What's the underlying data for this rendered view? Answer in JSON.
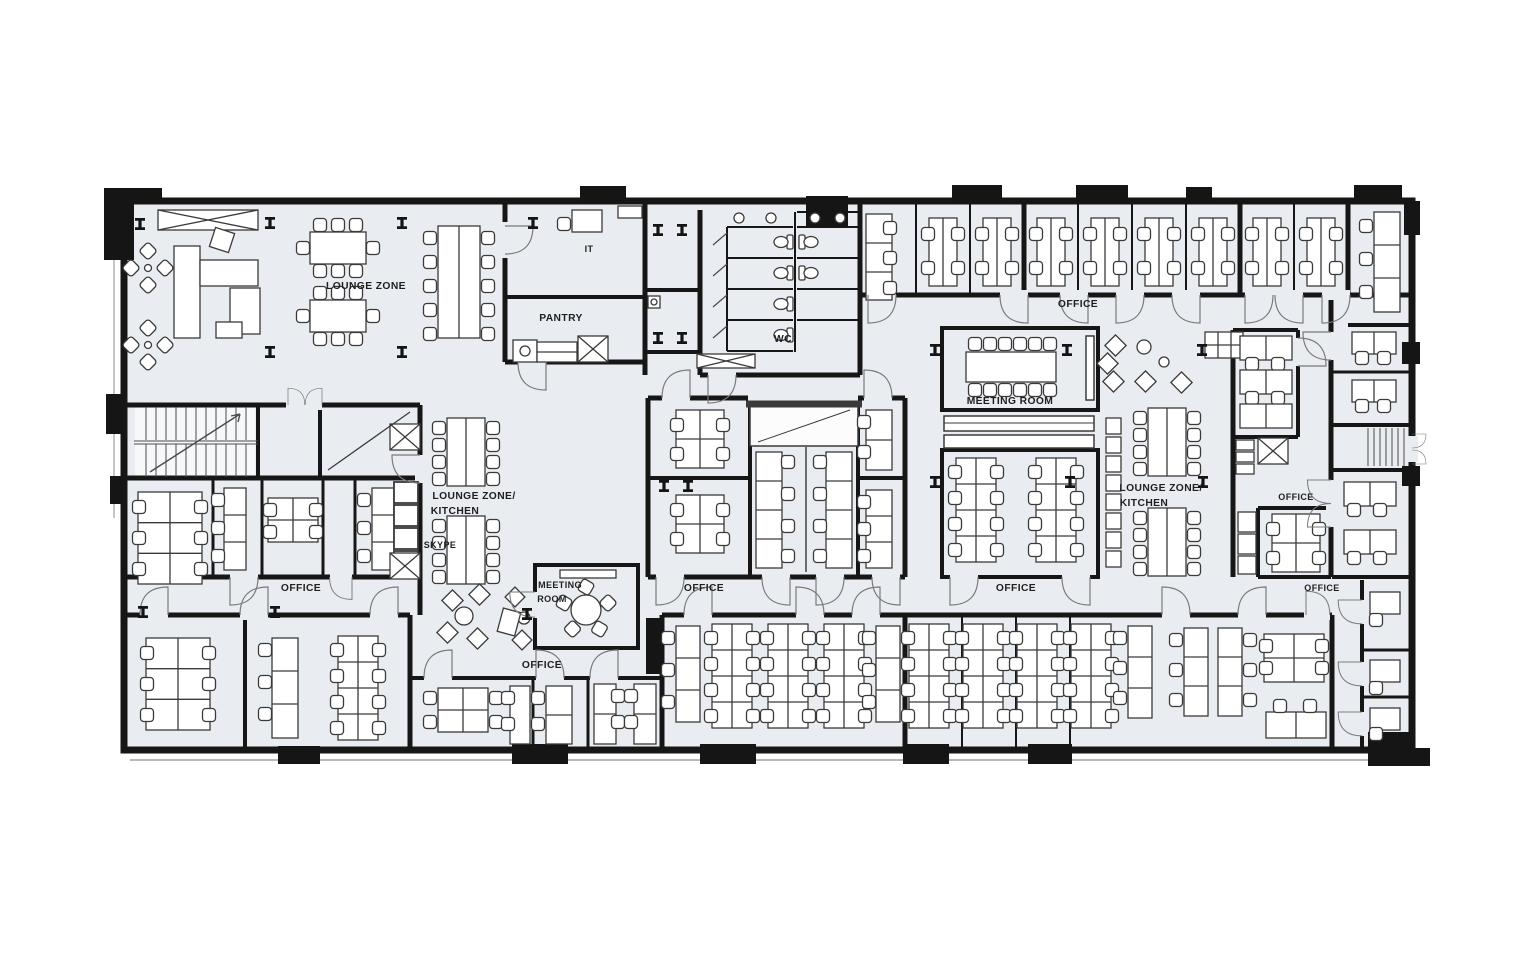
{
  "meta": {
    "title": "Office floor plan",
    "drawing_type": "architectural-floor-plan"
  },
  "colors": {
    "background": "#ffffff",
    "floor": "#e9edf2",
    "wall": "#161616",
    "furniture_stroke": "#3a3a3a",
    "door_stroke": "#7a7a7a",
    "label": "#1f1f1f"
  },
  "labels": [
    {
      "id": "lounge-zone-nw",
      "text": "LOUNGE ZONE"
    },
    {
      "id": "it-room",
      "text": "IT"
    },
    {
      "id": "pantry",
      "text": "PANTRY"
    },
    {
      "id": "wc",
      "text": "WC"
    },
    {
      "id": "office-north",
      "text": "OFFICE"
    },
    {
      "id": "meeting-room-main",
      "text": "MEETING ROOM"
    },
    {
      "id": "lounge-kitchen-west-1",
      "text": "LOUNGE ZONE/"
    },
    {
      "id": "lounge-kitchen-west-2",
      "text": "KITCHEN"
    },
    {
      "id": "skype-booth",
      "text": "SKYPE"
    },
    {
      "id": "meeting-room-small-1",
      "text": "MEETING"
    },
    {
      "id": "meeting-room-small-2",
      "text": "ROOM"
    },
    {
      "id": "office-west",
      "text": "OFFICE"
    },
    {
      "id": "office-center",
      "text": "OFFICE"
    },
    {
      "id": "office-mid-east",
      "text": "OFFICE"
    },
    {
      "id": "lounge-kitchen-east-1",
      "text": "LOUNGE ZONE/"
    },
    {
      "id": "lounge-kitchen-east-2",
      "text": "KITCHEN"
    },
    {
      "id": "office-east-upper",
      "text": "OFFICE"
    },
    {
      "id": "office-east-lower",
      "text": "OFFICE"
    },
    {
      "id": "office-south",
      "text": "OFFICE"
    }
  ]
}
